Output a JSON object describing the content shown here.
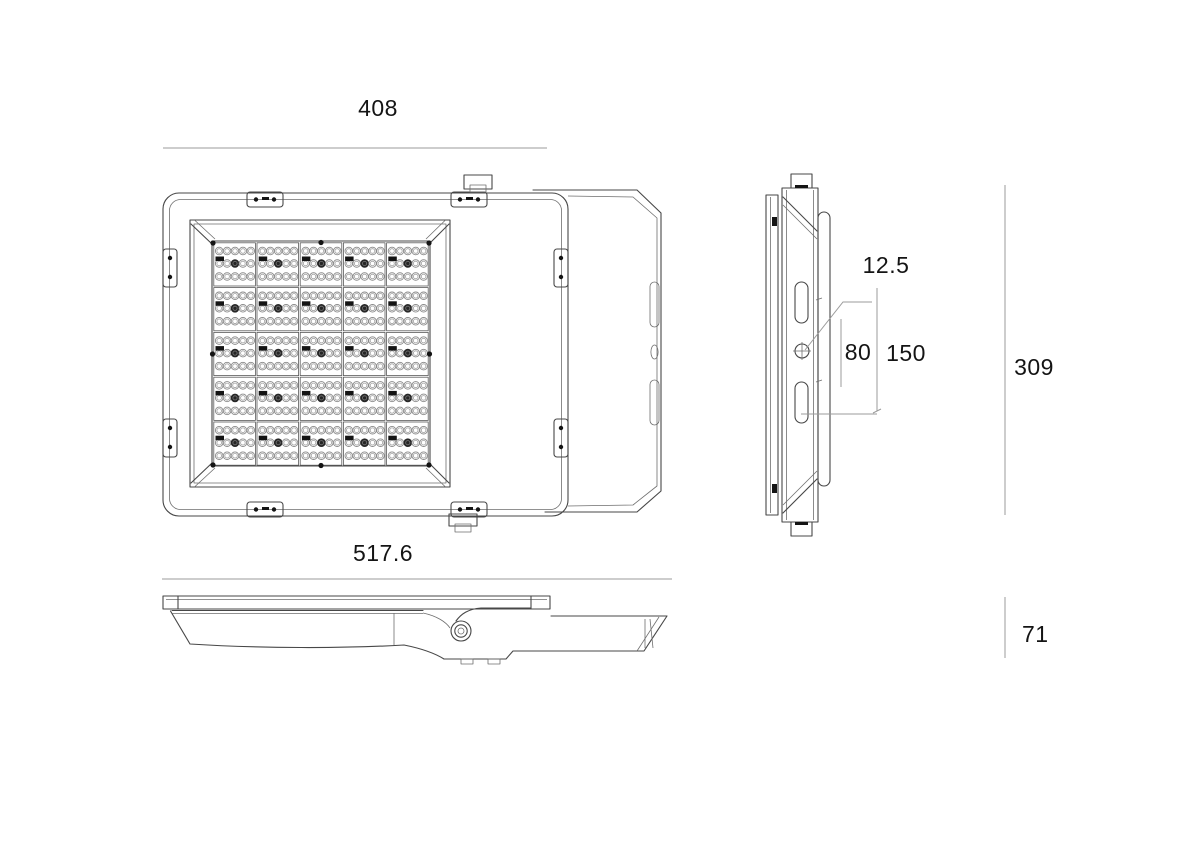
{
  "drawing": {
    "kind": "technical-dimension-drawing",
    "subject": "LED flood light luminaire, three orthographic views",
    "views": {
      "front": {
        "label": "front-view",
        "width_dim": "408"
      },
      "side": {
        "label": "side-view",
        "hole_dim": "12.5",
        "slot_offset_dim": "80",
        "slot_spacing_dim": "150",
        "height_dim": "309"
      },
      "profile": {
        "label": "profile-view",
        "length_dim": "517.6",
        "thickness_dim": "71"
      }
    },
    "led_grid": {
      "module_cols": 5,
      "module_rows": 5,
      "leds_per_row": 5,
      "led_rows_per_module": 3
    },
    "colors": {
      "background": "#ffffff",
      "outline": "#474747",
      "outline_light": "#6e6e6e",
      "dim_line": "#9b9b9b",
      "text": "#141414"
    }
  }
}
